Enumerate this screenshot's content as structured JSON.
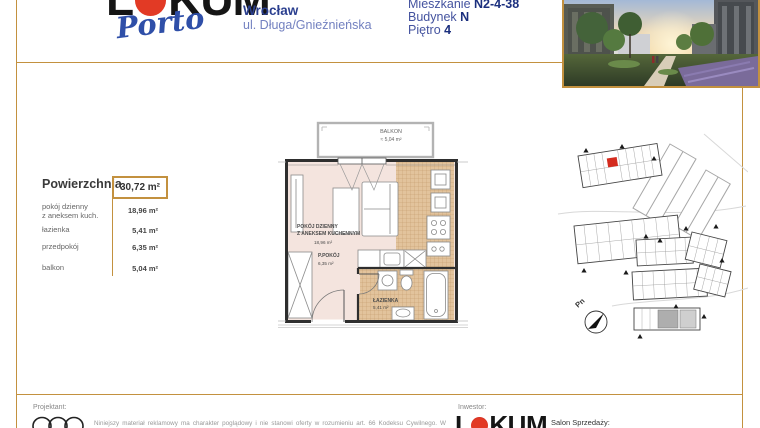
{
  "header": {
    "brand_part1": "L",
    "brand_part2": "KUM",
    "brand_sub": "Porto",
    "city": "Wrocław",
    "street": "ul. Długa/Gnieźnieńska",
    "apartment_label": "Mieszkanie ",
    "apartment_value": "N2-4-38",
    "building_label": "Budynek ",
    "building_value": "N",
    "floor_label": "Piętro ",
    "floor_value": "4"
  },
  "area_table": {
    "title": "Powierzchnia",
    "total_value": "30,72 m²",
    "rows": [
      {
        "label": "pokój dzienny\nz aneksem kuch.",
        "value": "18,96 m²"
      },
      {
        "label": "łazienka",
        "value": "5,41 m²"
      },
      {
        "label": "przedpokój",
        "value": "6,35 m²"
      },
      {
        "label": "balkon",
        "value": "5,04 m²"
      }
    ]
  },
  "plan": {
    "balcony_label": "BALKON",
    "balcony_area": "≈  5,04 m²",
    "living_line1": "POKÓJ DZIENNY",
    "living_line2": "Z ANEKSEM KUCHENNYM",
    "living_area": "18,96 m²",
    "hall_label": "P.POKÓJ",
    "hall_area": "6,35 m²",
    "bath_label": "ŁAZIENKA",
    "bath_area": "5,41 m²"
  },
  "site_map": {
    "north_label": "Pn"
  },
  "footer": {
    "designer_label": "Projektant:",
    "disclaimer": "Niniejszy materiał reklamowy ma charakter poglądowy i nie stanowi oferty w rozumieniu art. 66 Kodeksu Cywilnego. W związku z powyższym wiążące ustalenia stron następują w drodze umowy.",
    "investor_label": "Inwestor:",
    "investor_part1": "L",
    "investor_part2": "KUM",
    "sales_label": "Salon Sprzedaży:"
  },
  "colors": {
    "gold": "#c3913f",
    "blue_dark": "#1b2f7e",
    "blue_mid": "#44539f",
    "blue_light": "#7381c0",
    "brand_red": "#d42b1e",
    "plan_floor": "#f4e4de",
    "plan_tile": "#e2c39c"
  }
}
